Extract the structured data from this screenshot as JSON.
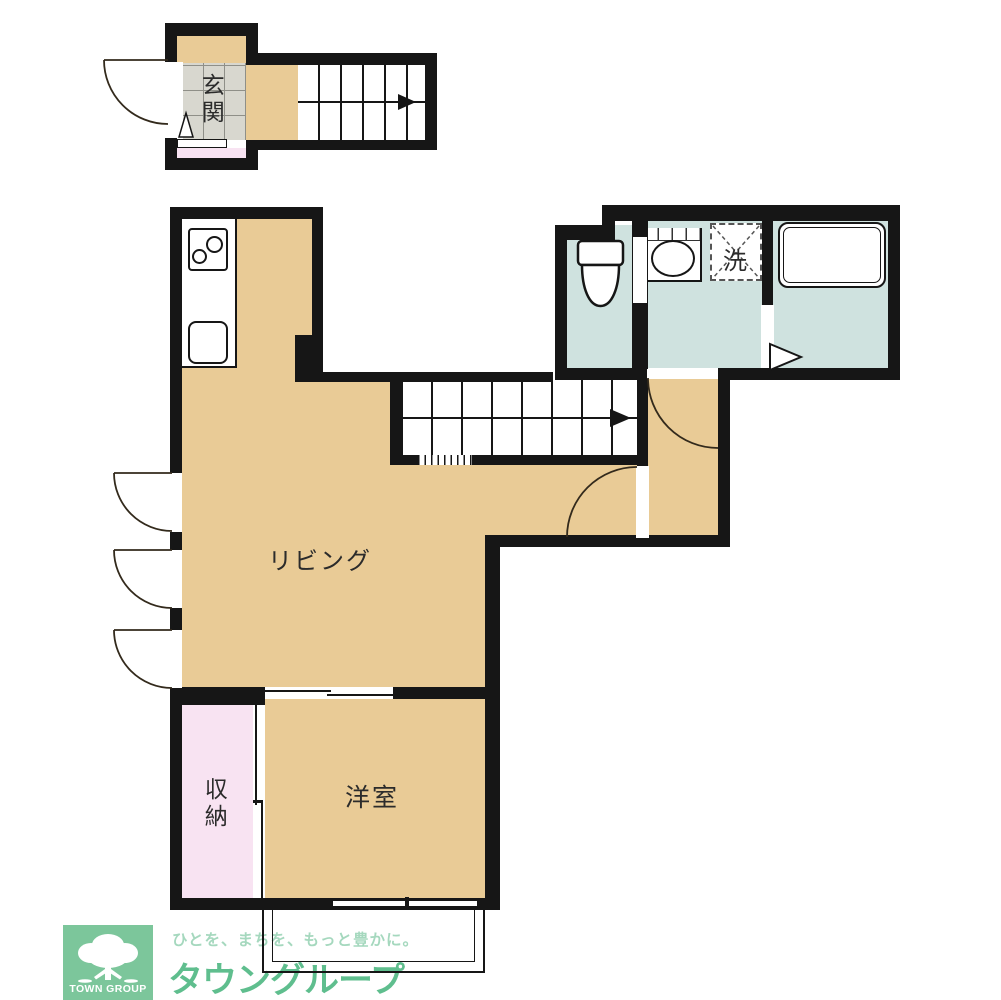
{
  "rooms": {
    "entrance": {
      "label": "玄関"
    },
    "living": {
      "label": "リビング"
    },
    "western_room": {
      "label": "洋室"
    },
    "storage": {
      "label": "収納"
    },
    "laundry": {
      "label": "洗"
    }
  },
  "logo": {
    "brand_jp": "タウングループ",
    "brand_en": "TOWN GROUP",
    "tagline": "ひとを、まちを、もっと豊かに。"
  },
  "colors": {
    "floor-tan": "#e9cb96",
    "wet-blue": "#cfe2df",
    "storage-pink": "#f8e3f2",
    "tile-gray": "#d8d7cf",
    "wall-black": "#161616",
    "logo-green": "#5fbe8e",
    "logo-green-light": "#a5d8be",
    "logo-square-green": "#7cc69b"
  }
}
